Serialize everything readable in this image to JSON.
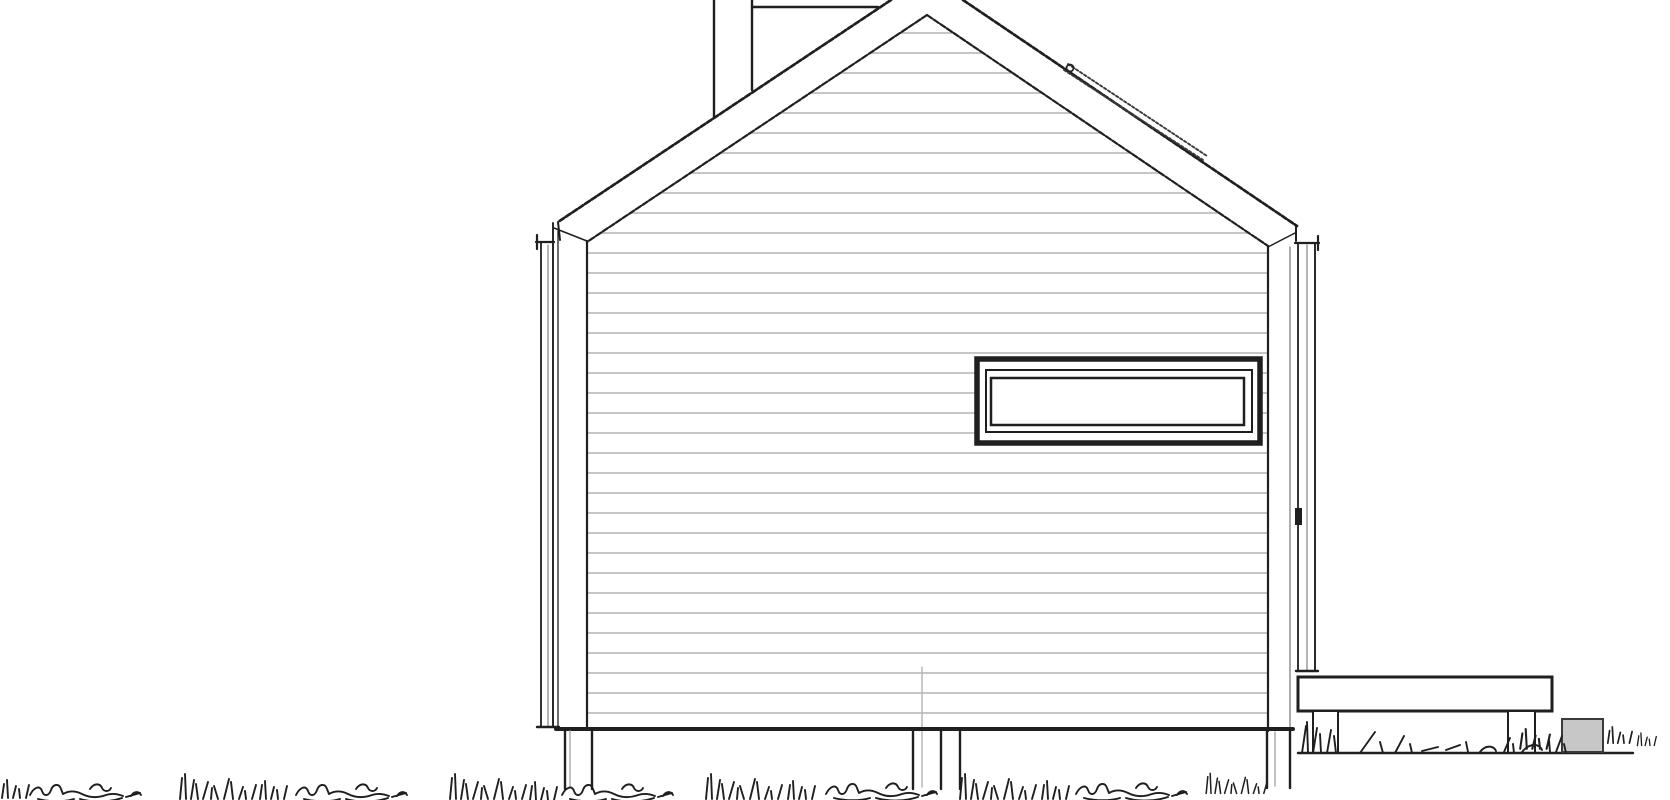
{
  "meta": {
    "description": "Hand-line architectural side elevation of a gable-roof cabin: horizontal lap siding, high strip window, rear ridge visible over roof, snow rail on right roof slope, corner downspouts, pile foundation posts, attached deck with supports, stone block and grass ground line"
  },
  "canvas": {
    "w": 1670,
    "h": 800
  },
  "colors": {
    "paper": "#ffffff",
    "ink": "#1f1f1f",
    "ink_soft": "#3a3a3a",
    "siding": "#b3b3b3",
    "pipe": "#bcbcbc",
    "post_inner": "#a8a8a8",
    "trim_soft": "#777777",
    "block_fill": "#c7c7c7"
  },
  "grass_defs": {
    "scribble": "M0 16 C4 8 10 6 12 12 C14 18 19 17 21 11 C23 5 29 4 31 10 L33 15 C40 11 46 12 52 15 C60 19 68 19 76 16 C82 14 88 15 93 17 M8 20 C20 23 34 23 44 20 M50 20 C64 24 80 23 92 19 M96 18 L110 14 M60 10 C64 4 70 4 72 9 C74 13 79 13 81 9 M101 17 C104 12 109 12 111 16",
    "tuft": "M4 28 L6 7 M10 28 L9 3 M15 28 L18 9 M22 28 L20 13 M27 28 L32 11 M35 28 L36 17 M42 28 L38 15 M48 28 L53 8 M57 28 L55 11 M63 28 L67 16 M70 28 L69 20 M76 28 L80 14",
    "tuft_small": "M2 18 L4 4 M8 18 L7 0 M13 18 L16 6 M20 18 L19 9 M26 18 L29 5",
    "deck_grass": "M2 39 L6 12 M8 39 L7 8 M13 39 L17 14 M21 39 L20 20 M27 39 L31 16 M36 39 L34 22 M60 39 L75 18 M83 39 L80 28 M95 39 L104 22 M112 39 L110 30 M122 37 L138 33 M146 36 L160 31 M168 38 L166 28 M180 38 C186 30 194 32 196 37 M204 38 L210 24 M214 39 L213 30 M222 38 C230 28 240 30 242 36 M250 38 L249 26 M256 38 L262 22 M266 39 L264 30"
  },
  "shapes": [
    {
      "t": "hl",
      "n": "siding-line",
      "y": 33,
      "a": 900,
      "b": 954
    },
    {
      "t": "hl",
      "n": "siding-line",
      "y": 53,
      "a": 870,
      "b": 983
    },
    {
      "t": "hl",
      "n": "siding-line",
      "y": 73,
      "a": 840,
      "b": 1013
    },
    {
      "t": "hl",
      "n": "siding-line",
      "y": 93,
      "a": 810,
      "b": 1042
    },
    {
      "t": "hl",
      "n": "siding-line",
      "y": 113,
      "a": 780,
      "b": 1072
    },
    {
      "t": "hl",
      "n": "siding-line",
      "y": 133,
      "a": 750,
      "b": 1101
    },
    {
      "t": "hl",
      "n": "siding-line",
      "y": 153,
      "a": 720,
      "b": 1131
    },
    {
      "t": "hl",
      "n": "siding-line",
      "y": 173,
      "a": 690,
      "b": 1160
    },
    {
      "t": "hl",
      "n": "siding-line",
      "y": 193,
      "a": 660,
      "b": 1190
    },
    {
      "t": "hl",
      "n": "siding-line",
      "y": 213,
      "a": 630,
      "b": 1219
    },
    {
      "t": "hl",
      "n": "siding-line",
      "y": 233,
      "a": 600,
      "b": 1249
    },
    {
      "t": "hl",
      "n": "siding-line",
      "y": 253,
      "a": 587,
      "b": 1268
    },
    {
      "t": "hl",
      "n": "siding-line",
      "y": 273,
      "a": 587,
      "b": 1268
    },
    {
      "t": "hl",
      "n": "siding-line",
      "y": 293,
      "a": 587,
      "b": 1268
    },
    {
      "t": "hl",
      "n": "siding-line",
      "y": 313,
      "a": 587,
      "b": 1268
    },
    {
      "t": "hl",
      "n": "siding-line",
      "y": 333,
      "a": 587,
      "b": 1268
    },
    {
      "t": "hl",
      "n": "siding-line",
      "y": 353,
      "a": 587,
      "b": 1268
    },
    {
      "t": "hl",
      "n": "siding-line",
      "y": 373,
      "a": 587,
      "b": 977
    },
    {
      "t": "hl",
      "n": "siding-line",
      "y": 373,
      "a": 1260,
      "b": 1268
    },
    {
      "t": "hl",
      "n": "siding-line",
      "y": 393,
      "a": 587,
      "b": 977
    },
    {
      "t": "hl",
      "n": "siding-line",
      "y": 393,
      "a": 1260,
      "b": 1268
    },
    {
      "t": "hl",
      "n": "siding-line",
      "y": 413,
      "a": 587,
      "b": 977
    },
    {
      "t": "hl",
      "n": "siding-line",
      "y": 413,
      "a": 1260,
      "b": 1268
    },
    {
      "t": "hl",
      "n": "siding-line",
      "y": 433,
      "a": 587,
      "b": 977
    },
    {
      "t": "hl",
      "n": "siding-line",
      "y": 433,
      "a": 1260,
      "b": 1268
    },
    {
      "t": "hl",
      "n": "siding-line",
      "y": 453,
      "a": 587,
      "b": 1268
    },
    {
      "t": "hl",
      "n": "siding-line",
      "y": 473,
      "a": 587,
      "b": 1268
    },
    {
      "t": "hl",
      "n": "siding-line",
      "y": 493,
      "a": 587,
      "b": 1268
    },
    {
      "t": "hl",
      "n": "siding-line",
      "y": 513,
      "a": 587,
      "b": 1268
    },
    {
      "t": "hl",
      "n": "siding-line",
      "y": 533,
      "a": 587,
      "b": 1268
    },
    {
      "t": "hl",
      "n": "siding-line",
      "y": 553,
      "a": 587,
      "b": 1268
    },
    {
      "t": "hl",
      "n": "siding-line",
      "y": 573,
      "a": 587,
      "b": 1268
    },
    {
      "t": "hl",
      "n": "siding-line",
      "y": 593,
      "a": 587,
      "b": 1268
    },
    {
      "t": "hl",
      "n": "siding-line",
      "y": 613,
      "a": 587,
      "b": 1268
    },
    {
      "t": "hl",
      "n": "siding-line",
      "y": 633,
      "a": 587,
      "b": 1268
    },
    {
      "t": "hl",
      "n": "siding-line",
      "y": 653,
      "a": 587,
      "b": 1268
    },
    {
      "t": "hl",
      "n": "siding-line",
      "y": 673,
      "a": 587,
      "b": 1268
    },
    {
      "t": "hl",
      "n": "siding-line",
      "y": 693,
      "a": 587,
      "b": 1268
    },
    {
      "t": "hl",
      "n": "siding-line",
      "y": 713,
      "a": 587,
      "b": 1268
    },
    {
      "t": "ln",
      "n": "rain-pipe-gray",
      "p": [
        922,
        667,
        922,
        787
      ],
      "w": 1.6,
      "c": "pipe"
    },
    {
      "t": "rc",
      "n": "window-frame-outer",
      "x": 977,
      "y": 359,
      "w": 283,
      "h": 84,
      "sw": 5.5,
      "sc": "ink",
      "f": "paper"
    },
    {
      "t": "rc",
      "n": "window-frame-mid",
      "x": 986,
      "y": 370,
      "w": 266,
      "h": 62,
      "sw": 2,
      "sc": "ink",
      "f": "none"
    },
    {
      "t": "rc",
      "n": "window-glass",
      "x": 991,
      "y": 378,
      "w": 253,
      "h": 47,
      "sw": 2.5,
      "sc": "ink",
      "f": "paper"
    },
    {
      "t": "ln",
      "n": "rear-ridge-line",
      "p": [
        752,
        7,
        878,
        7
      ],
      "w": 2.4
    },
    {
      "t": "ln",
      "n": "rear-wall-edge-left",
      "p": [
        714,
        0,
        714,
        117
      ],
      "w": 2.4
    },
    {
      "t": "ln",
      "n": "rear-wall-edge-right",
      "p": [
        752,
        0,
        752,
        90
      ],
      "w": 2.4
    },
    {
      "t": "ln",
      "n": "roof-outer-left",
      "p": [
        891,
        0,
        558,
        222
      ],
      "w": 2.7,
      "d": "5.5 2.2"
    },
    {
      "t": "ln",
      "n": "roof-outer-right",
      "p": [
        963,
        0,
        1297,
        226
      ],
      "w": 2.7,
      "d": "5.5 2.2"
    },
    {
      "t": "ln",
      "n": "roof-inner-left",
      "p": [
        927,
        15,
        587,
        242
      ],
      "w": 2.2,
      "d": "6 2"
    },
    {
      "t": "ln",
      "n": "roof-inner-right",
      "p": [
        927,
        15,
        1268,
        246
      ],
      "w": 2.2,
      "d": "6 2"
    },
    {
      "t": "ln",
      "n": "snow-rail-upper",
      "p": [
        1068,
        64,
        1207,
        156
      ],
      "w": 1.9,
      "c": "ink_soft",
      "d": "2.6 2.2"
    },
    {
      "t": "ln",
      "n": "snow-rail-lower",
      "p": [
        1064,
        70,
        1203,
        160
      ],
      "w": 1.9,
      "c": "ink_soft",
      "d": "2.6 2.2"
    },
    {
      "t": "ci",
      "n": "snow-rail-hook",
      "cx": 1070,
      "cy": 68,
      "r": 3.5,
      "sw": 1.7
    },
    {
      "t": "ln",
      "n": "fascia-left-end",
      "p": [
        558,
        222,
        560,
        240
      ],
      "w": 2
    },
    {
      "t": "ln",
      "n": "eave-left-underside",
      "p": [
        554,
        228,
        587,
        241
      ],
      "w": 1.5
    },
    {
      "t": "ln",
      "n": "fascia-right-end",
      "p": [
        1296,
        226,
        1296,
        241
      ],
      "w": 2
    },
    {
      "t": "ln",
      "n": "eave-right-underside",
      "p": [
        1295,
        233,
        1268,
        247
      ],
      "w": 1.5
    },
    {
      "t": "ln",
      "n": "wall-corner-left",
      "p": [
        587,
        241,
        587,
        729
      ],
      "w": 2.2
    },
    {
      "t": "ln",
      "n": "wall-corner-right",
      "p": [
        1268,
        246,
        1268,
        731
      ],
      "w": 2.2
    },
    {
      "t": "ln",
      "n": "corner-board-right-edge",
      "p": [
        1290,
        247,
        1290,
        730
      ],
      "w": 1.2,
      "c": "trim_soft"
    },
    {
      "t": "ln",
      "n": "downspout-left-outer",
      "p": [
        541,
        243,
        541,
        727
      ],
      "w": 1.8
    },
    {
      "t": "ln",
      "n": "downspout-left-pipe",
      "p": [
        548,
        245,
        548,
        726
      ],
      "w": 1.1,
      "c": "trim_soft"
    },
    {
      "t": "ln",
      "n": "downspout-left-inner",
      "p": [
        553,
        223,
        553,
        727
      ],
      "w": 1.9
    },
    {
      "t": "ln",
      "n": "downspout-left-edge",
      "p": [
        558,
        231,
        558,
        727
      ],
      "w": 1.3
    },
    {
      "t": "ln",
      "n": "gutter-bracket-left-h",
      "p": [
        536,
        242,
        554,
        242
      ],
      "w": 2.2
    },
    {
      "t": "ln",
      "n": "gutter-bracket-left-v",
      "p": [
        537,
        235,
        537,
        249
      ],
      "w": 2.2
    },
    {
      "t": "ln",
      "n": "downspout-left-foot",
      "p": [
        537,
        727,
        559,
        727
      ],
      "w": 2.4
    },
    {
      "t": "ln",
      "n": "downspout-right-inner",
      "p": [
        1298,
        243,
        1298,
        671
      ],
      "w": 1.8
    },
    {
      "t": "ln",
      "n": "downspout-right-pipe",
      "p": [
        1307,
        245,
        1307,
        671
      ],
      "w": 1.1,
      "c": "trim_soft"
    },
    {
      "t": "ln",
      "n": "downspout-right-outer",
      "p": [
        1315,
        243,
        1315,
        671
      ],
      "w": 1.9
    },
    {
      "t": "ln",
      "n": "gutter-bracket-right-h",
      "p": [
        1295,
        243,
        1319,
        243
      ],
      "w": 2.2
    },
    {
      "t": "ln",
      "n": "gutter-bracket-right-v",
      "p": [
        1318,
        236,
        1318,
        250
      ],
      "w": 2.2
    },
    {
      "t": "ln",
      "n": "downspout-right-foot",
      "p": [
        1296,
        671,
        1318,
        671
      ],
      "w": 2.4
    },
    {
      "t": "rc",
      "n": "downspout-right-clamp",
      "x": 1295,
      "y": 508,
      "w": 7,
      "h": 17,
      "sw": 0,
      "sc": "ink",
      "f": "ink"
    },
    {
      "t": "ln",
      "n": "wall-base-edge",
      "p": [
        556,
        729,
        1293,
        729
      ],
      "w": 4
    },
    {
      "t": "ln",
      "n": "foundation-post-left-a",
      "p": [
        565,
        731,
        565,
        789
      ],
      "w": 2.4
    },
    {
      "t": "ln",
      "n": "foundation-post-left-gray",
      "p": [
        570,
        731,
        570,
        786
      ],
      "w": 1.4,
      "c": "post_inner"
    },
    {
      "t": "ln",
      "n": "foundation-post-left-b",
      "p": [
        592,
        731,
        592,
        789
      ],
      "w": 2.4
    },
    {
      "t": "ln",
      "n": "foundation-post-mid-a",
      "p": [
        913,
        731,
        913,
        789
      ],
      "w": 2.4
    },
    {
      "t": "ln",
      "n": "foundation-post-mid-b",
      "p": [
        941,
        731,
        941,
        789
      ],
      "w": 2.4
    },
    {
      "t": "ln",
      "n": "foundation-post-mid-c",
      "p": [
        960,
        731,
        960,
        789
      ],
      "w": 2.4
    },
    {
      "t": "ln",
      "n": "foundation-post-right-a",
      "p": [
        1267,
        731,
        1267,
        788
      ],
      "w": 2.4
    },
    {
      "t": "ln",
      "n": "foundation-post-right-gray",
      "p": [
        1275,
        732,
        1275,
        786
      ],
      "w": 1.4,
      "c": "post_inner"
    },
    {
      "t": "ln",
      "n": "foundation-post-right-b",
      "p": [
        1290,
        731,
        1290,
        788
      ],
      "w": 2.4
    },
    {
      "t": "rc",
      "n": "deck-slab",
      "x": 1298,
      "y": 677,
      "w": 254,
      "h": 34,
      "sw": 3,
      "sc": "ink",
      "f": "paper"
    },
    {
      "t": "rc",
      "n": "deck-support-left",
      "x": 1313,
      "y": 711,
      "w": 25,
      "h": 42,
      "sw": 2,
      "sc": "ink",
      "f": "paper"
    },
    {
      "t": "rc",
      "n": "deck-support-right",
      "x": 1508,
      "y": 711,
      "w": 27,
      "h": 42,
      "sw": 2,
      "sc": "ink",
      "f": "paper"
    },
    {
      "t": "ln",
      "n": "ground-line-right",
      "p": [
        1298,
        753,
        1633,
        753
      ],
      "w": 2.4
    },
    {
      "t": "rc",
      "n": "stone-block",
      "x": 1562,
      "y": 719,
      "w": 41,
      "h": 33,
      "sw": 2,
      "sc": "ink_soft",
      "f": "block_fill"
    },
    {
      "t": "gp",
      "n": "grass-deck-band",
      "d": "deck_grass",
      "x": 1300,
      "y": 714,
      "s": 1
    },
    {
      "t": "gp",
      "n": "grass-tuft",
      "d": "tuft_small",
      "x": 1518,
      "y": 729,
      "s": 1.1
    },
    {
      "t": "gp",
      "n": "grass-tuft",
      "d": "tuft_small",
      "x": 1606,
      "y": 727,
      "s": 0.9
    },
    {
      "t": "gp",
      "n": "grass-tuft",
      "d": "tuft_small",
      "x": 1636,
      "y": 733,
      "s": 0.7
    },
    {
      "t": "gp",
      "n": "grass-tuft",
      "d": "tuft_small",
      "x": 0,
      "y": 780,
      "s": 1
    },
    {
      "t": "gp",
      "n": "grass-scribble",
      "d": "scribble",
      "x": 30,
      "y": 779,
      "s": 1
    },
    {
      "t": "gp",
      "n": "grass-tuft",
      "d": "tuft",
      "x": 176,
      "y": 771,
      "s": 1
    },
    {
      "t": "gp",
      "n": "grass-tuft",
      "d": "tuft_small",
      "x": 258,
      "y": 781,
      "s": 1
    },
    {
      "t": "gp",
      "n": "grass-scribble",
      "d": "scribble",
      "x": 296,
      "y": 779,
      "s": 1
    },
    {
      "t": "gp",
      "n": "grass-tuft",
      "d": "tuft",
      "x": 446,
      "y": 771,
      "s": 1
    },
    {
      "t": "gp",
      "n": "grass-tuft",
      "d": "tuft_small",
      "x": 528,
      "y": 782,
      "s": 1
    },
    {
      "t": "gp",
      "n": "grass-scribble",
      "d": "scribble",
      "x": 562,
      "y": 779,
      "s": 1
    },
    {
      "t": "gp",
      "n": "grass-tuft",
      "d": "tuft",
      "x": 702,
      "y": 771,
      "s": 1
    },
    {
      "t": "gp",
      "n": "grass-tuft",
      "d": "tuft_small",
      "x": 786,
      "y": 781,
      "s": 1
    },
    {
      "t": "gp",
      "n": "grass-scribble",
      "d": "scribble",
      "x": 826,
      "y": 778,
      "s": 1
    },
    {
      "t": "gp",
      "n": "grass-tuft",
      "d": "tuft",
      "x": 956,
      "y": 771,
      "s": 1
    },
    {
      "t": "gp",
      "n": "grass-tuft",
      "d": "tuft_small",
      "x": 1040,
      "y": 781,
      "s": 1
    },
    {
      "t": "gp",
      "n": "grass-scribble",
      "d": "scribble",
      "x": 1076,
      "y": 778,
      "s": 1
    },
    {
      "t": "gp",
      "n": "grass-tuft",
      "d": "tuft",
      "x": 1203,
      "y": 771,
      "s": 0.8
    }
  ]
}
